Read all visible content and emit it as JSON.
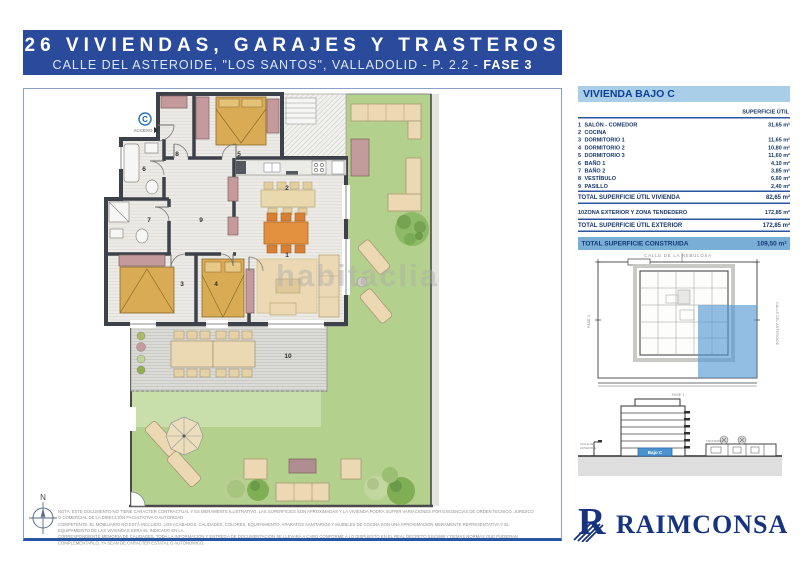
{
  "header": {
    "title": "26 VIVIENDAS, GARAJES Y TRASTEROS",
    "subtitle_regular": "CALLE DEL ASTEROIDE, \"LOS SANTOS\", VALLADOLID - P. 2.2 - ",
    "subtitle_bold": "FASE 3"
  },
  "panel": {
    "title": "VIVIENDA BAJO C",
    "col_header": "SUPERFICIE ÚTIL",
    "rows": [
      {
        "num": "1",
        "label": "SALÓN - COMEDOR",
        "value": "31,65 m²"
      },
      {
        "num": "2",
        "label": "COCINA",
        "value": ""
      },
      {
        "num": "3",
        "label": "DORMITORIO 1",
        "value": "11,65 m²"
      },
      {
        "num": "4",
        "label": "DORMITORIO 2",
        "value": "10,80 m²"
      },
      {
        "num": "5",
        "label": "DORMITORIO 3",
        "value": "11,60 m²"
      },
      {
        "num": "6",
        "label": "BAÑO 1",
        "value": "4,10 m²"
      },
      {
        "num": "7",
        "label": "BAÑO 2",
        "value": "3,85 m²"
      },
      {
        "num": "8",
        "label": "VESTÍBULO",
        "value": "6,60 m²"
      },
      {
        "num": "9",
        "label": "PASILLO",
        "value": "2,40 m²"
      }
    ],
    "total_vivienda": {
      "label": "TOTAL SUPERFICIE ÚTIL VIVIENDA",
      "value": "82,65 m²"
    },
    "exterior_row": {
      "num": "10",
      "label": "ZONA EXTERIOR Y ZONA TENDEDERO",
      "value": "172,85 m²"
    },
    "total_exterior": {
      "label": "TOTAL SUPERFICIE ÚTIL EXTERIOR",
      "value": "172,85 m²"
    },
    "total_construida": {
      "label": "TOTAL SUPERFICIE CONSTRUIDA",
      "value": "109,50 m²"
    }
  },
  "site_plan": {
    "street_top": "CALLE DE LA NEBULOSA",
    "street_right": "CALLE DEL ASTEROIDE",
    "label_left": "FASE 4",
    "label_bottom": "FASE 1"
  },
  "section": {
    "unit_label": "Bajo C",
    "left_label_line1": "CALLE DEL",
    "left_label_line2": "ASTEROIDE",
    "right_label": "TRASTEROS"
  },
  "floor_plan": {
    "access_letter": "C",
    "access_label": "ACCESO",
    "compass_label": "N",
    "room_labels": [
      "1",
      "2",
      "3",
      "4",
      "5",
      "6",
      "7",
      "8",
      "9",
      "10"
    ]
  },
  "watermark": {
    "text": "habitaclia"
  },
  "footer": {
    "disclaimer": [
      "NOTA: ESTE DOCUMENTO NO TIENE CARÁCTER CONTRACTUAL Y ES MERAMENTE ILUSTRATIVO. LAS SUPERFICIES SON APROXIMADAS Y LA VIVIENDA PODRÁ SUFRIR VARIACIONES POR EXIGENCIAS DE ORDEN TÉCNICO, JURÍDICO O COMERCIAL DE LA DIRECCIÓN FACULTATIVA O AUTORIDAD",
      "COMPETENTE. EL MOBILIARIO NO ESTÁ INCLUIDO. LOS ACABADOS, CALIDADES, COLORES, EQUIPAMIENTO, APARATOS SANITARIOS Y MUEBLES DE COCINA SON UNA APROXIMACIÓN MERAMENTE REPRESENTATIVA Y EL EQUIPAMIENTO DE LAS VIVIENDAS SERÁ EL INDICADO EN LA",
      "CORRESPONDIENTE MEMORIA DE CALIDADES. TODA LA INFORMACIÓN Y ENTREGA DE DOCUMENTACIÓN SE LLEVARÁ A CABO CONFORME A LO DISPUESTO EN EL REAL DECRETO 515/1989 Y DEMÁS NORMAS QUE PUDIERAN COMPLEMENTARLO, YA SEAN DE CARÁCTER ESTATAL O AUTONÓMICO."
    ],
    "logo_text": "RAIMCONSA"
  },
  "colors": {
    "banner_blue": "#2a4a9c",
    "navy_text": "#17376b",
    "panel_header_bg": "#a9cee8",
    "highlight_bg": "#79aed6",
    "plan_highlight_blue": "#4f96d2",
    "logo_navy": "#15337f",
    "garden_green": "#b3d18d",
    "bed_tan": "#d9ab55",
    "wardrobe_mauve": "#c59a9c",
    "sofa_cream": "#ecd9b4",
    "chair_orange": "#e2903e",
    "wall_dark": "#3d424a"
  }
}
